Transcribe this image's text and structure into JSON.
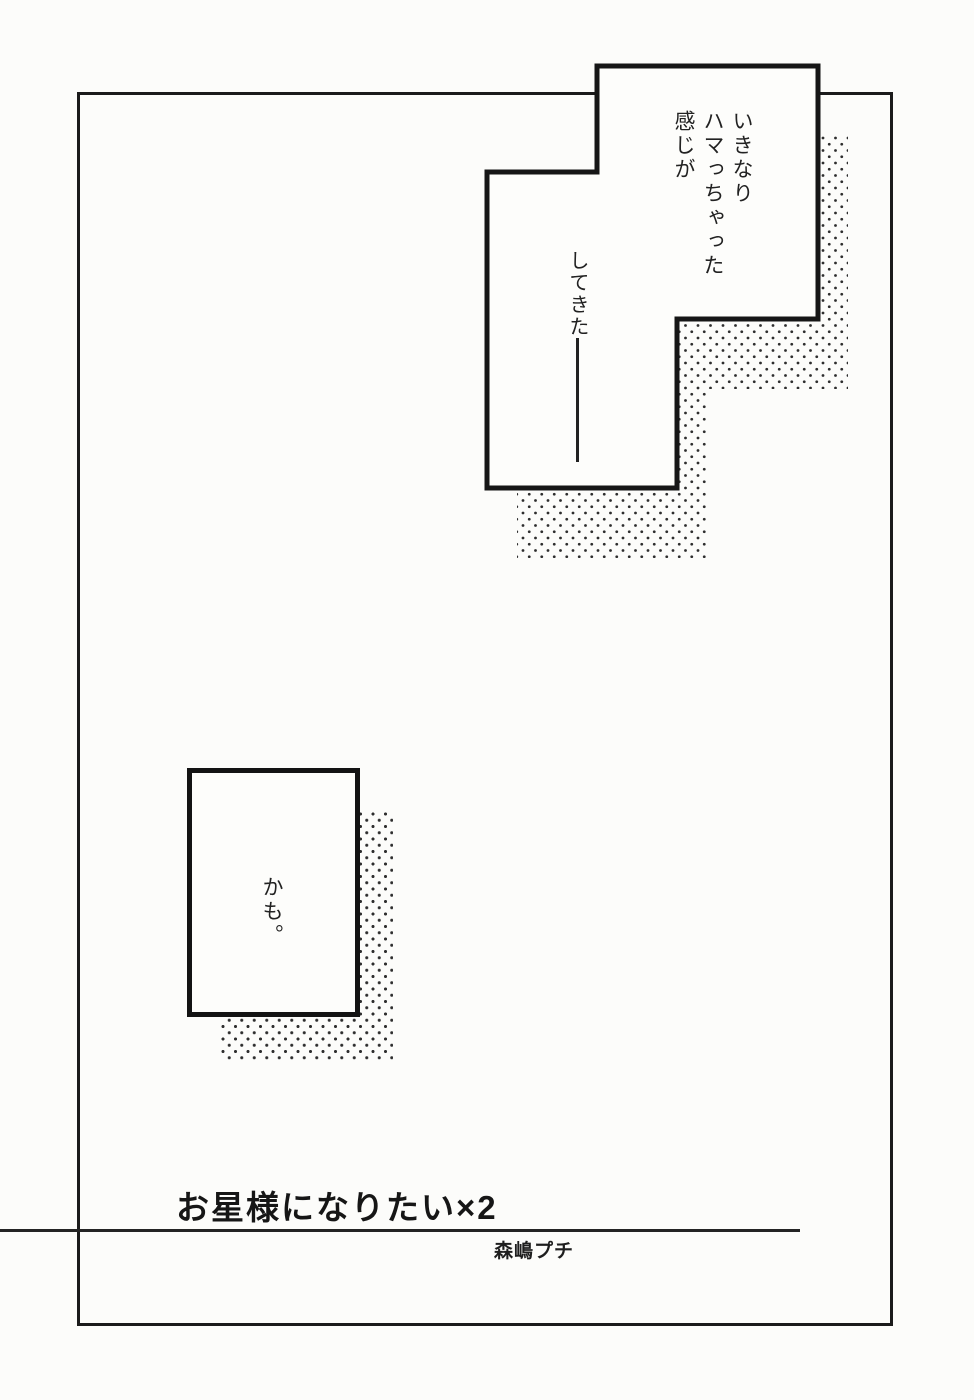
{
  "colors": {
    "paper": "#fcfcfa",
    "ink": "#1b1b1b",
    "halftone_dot": "#2e2e2e"
  },
  "page": {
    "panel_top": {
      "lines": [
        "いきなり",
        "ハマっちゃった",
        "感じが"
      ],
      "line2": "してきた"
    },
    "panel_bottom": {
      "text": "かも。"
    },
    "title_block": {
      "title": "お星様になりたい×2",
      "author": "森嶋プチ"
    }
  }
}
